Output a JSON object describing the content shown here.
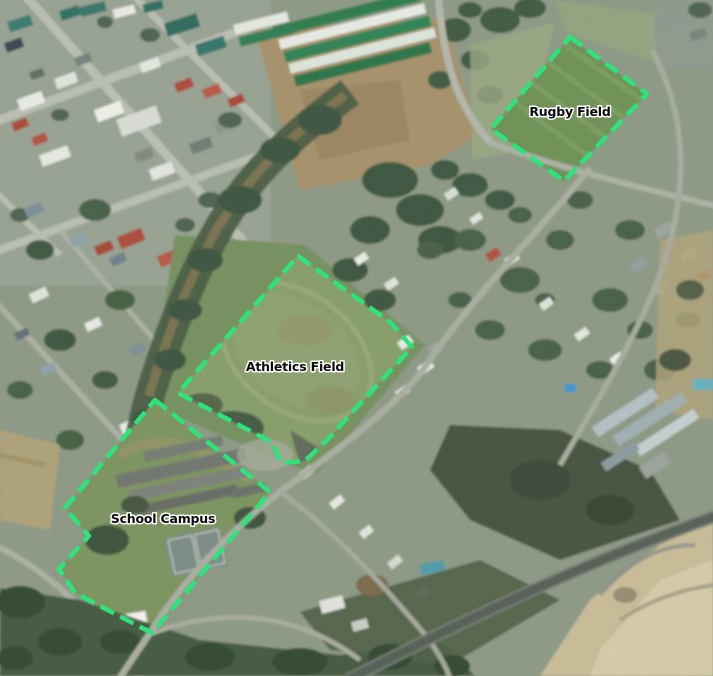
{
  "map": {
    "description": "aerial imagery of a town with digitized school property polygons",
    "annotation_style": {
      "stroke_color": "#2DE47C",
      "stroke_width": 4.5,
      "dash_pattern": "15 7",
      "label_color": "#0a0a0a",
      "label_halo_color": "#ffffff"
    },
    "features": [
      {
        "id": "rugby-field",
        "label": "Rugby Field",
        "points": "570,37 647,94 564,181 491,129",
        "label_x": 570,
        "label_y": 116
      },
      {
        "id": "athletics-field",
        "label": "Athletics Field",
        "points": "298,256 390,322 412,347 327,440 305,461 281,463 273,443 178,393",
        "label_x": 295,
        "label_y": 371
      },
      {
        "id": "school-campus",
        "label": "School Campus",
        "points": "155,400 270,492 152,633 75,593 59,569 89,536 65,508",
        "label_x": 163,
        "label_y": 523
      }
    ]
  }
}
